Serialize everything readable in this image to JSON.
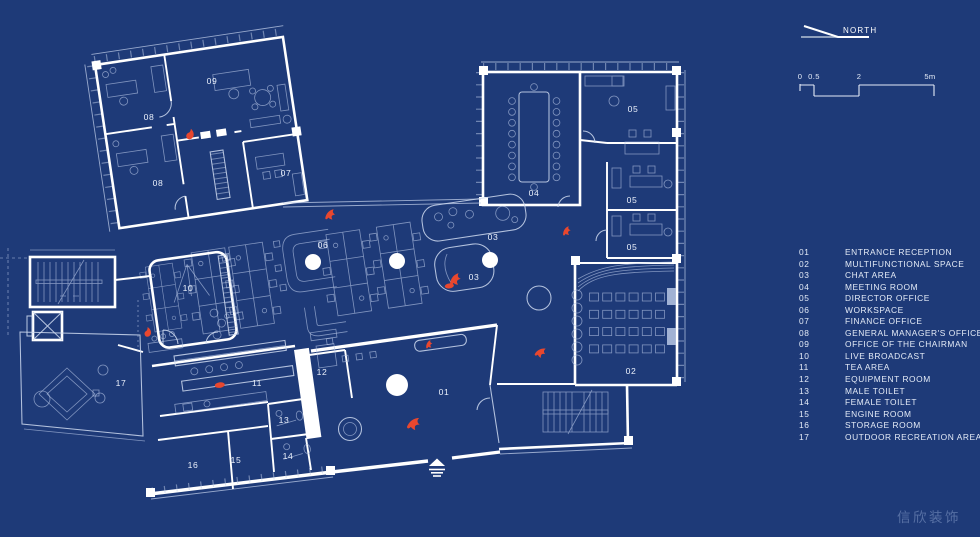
{
  "north": {
    "label": "NORTH"
  },
  "scale_bar": {
    "ticks": [
      {
        "label": "0",
        "x": 800
      },
      {
        "label": "0.5",
        "x": 814
      },
      {
        "label": "2",
        "x": 859
      },
      {
        "label": "5m",
        "x": 930
      }
    ]
  },
  "legend": {
    "items": [
      {
        "num": "01",
        "name": "ENTRANCE RECEPTION"
      },
      {
        "num": "02",
        "name": "MULTIFUNCTIONAL SPACE"
      },
      {
        "num": "03",
        "name": "CHAT AREA"
      },
      {
        "num": "04",
        "name": "MEETING ROOM"
      },
      {
        "num": "05",
        "name": "DIRECTOR OFFICE"
      },
      {
        "num": "06",
        "name": "WORKSPACE"
      },
      {
        "num": "07",
        "name": "FINANCE OFFICE"
      },
      {
        "num": "08",
        "name": "GENERAL MANAGER'S OFFICE"
      },
      {
        "num": "09",
        "name": "OFFICE OF THE CHAIRMAN"
      },
      {
        "num": "10",
        "name": "LIVE BROADCAST"
      },
      {
        "num": "11",
        "name": "TEA AREA"
      },
      {
        "num": "12",
        "name": "EQUIPMENT ROOM"
      },
      {
        "num": "13",
        "name": "MALE TOILET"
      },
      {
        "num": "14",
        "name": "FEMALE TOILET"
      },
      {
        "num": "15",
        "name": "ENGINE ROOM"
      },
      {
        "num": "16",
        "name": "STORAGE ROOM"
      },
      {
        "num": "17",
        "name": "OUTDOOR RECREATION AREA"
      }
    ]
  },
  "plan": {
    "room_labels": [
      {
        "num": "01",
        "x": 444,
        "y": 395
      },
      {
        "num": "02",
        "x": 631,
        "y": 374
      },
      {
        "num": "03",
        "x": 493,
        "y": 240
      },
      {
        "num": "03",
        "x": 474,
        "y": 280
      },
      {
        "num": "04",
        "x": 534,
        "y": 196
      },
      {
        "num": "05",
        "x": 633,
        "y": 112
      },
      {
        "num": "05",
        "x": 632,
        "y": 203
      },
      {
        "num": "05",
        "x": 632,
        "y": 250
      },
      {
        "num": "06",
        "x": 323,
        "y": 248
      },
      {
        "num": "07",
        "x": 286,
        "y": 176
      },
      {
        "num": "08",
        "x": 149,
        "y": 120
      },
      {
        "num": "08",
        "x": 158,
        "y": 186
      },
      {
        "num": "09",
        "x": 212,
        "y": 84
      },
      {
        "num": "10",
        "x": 188,
        "y": 291
      },
      {
        "num": "11",
        "x": 257,
        "y": 386
      },
      {
        "num": "12",
        "x": 322,
        "y": 375
      },
      {
        "num": "13",
        "x": 284,
        "y": 423
      },
      {
        "num": "14",
        "x": 288,
        "y": 459
      },
      {
        "num": "15",
        "x": 236,
        "y": 463
      },
      {
        "num": "16",
        "x": 193,
        "y": 468
      },
      {
        "num": "17",
        "x": 121,
        "y": 386
      }
    ],
    "columns": [
      {
        "x": 313,
        "y": 262,
        "r": 8
      },
      {
        "x": 397,
        "y": 261,
        "r": 8
      },
      {
        "x": 490,
        "y": 260,
        "r": 8
      },
      {
        "x": 397,
        "y": 385,
        "r": 11
      }
    ],
    "red_marks": [
      {
        "type": "flame",
        "x": 187,
        "y": 128,
        "rot": 10,
        "s": 1
      },
      {
        "type": "bird",
        "x": 324,
        "y": 211,
        "rot": -10,
        "s": 0.9
      },
      {
        "type": "bird",
        "x": 448,
        "y": 276,
        "rot": -15,
        "s": 1
      },
      {
        "type": "blob",
        "x": 445,
        "y": 284,
        "rot": -8,
        "s": 1
      },
      {
        "type": "bird",
        "x": 561,
        "y": 229,
        "rot": -20,
        "s": 0.75
      },
      {
        "type": "bird",
        "x": 536,
        "y": 347,
        "rot": 10,
        "s": 0.9
      },
      {
        "type": "flame",
        "x": 144,
        "y": 327,
        "rot": 0,
        "s": 0.9
      },
      {
        "type": "blob",
        "x": 215,
        "y": 383,
        "rot": -8,
        "s": 1.1
      },
      {
        "type": "bird",
        "x": 407,
        "y": 418,
        "rot": 0,
        "s": 1.1
      },
      {
        "type": "bird",
        "x": 424,
        "y": 343,
        "rot": -25,
        "s": 0.65
      }
    ]
  },
  "watermark": {
    "text": "信欣装饰"
  },
  "colors": {
    "background": "#1e3a78",
    "wall": "#ffffff",
    "detail_line": "#b7c6e6",
    "accent_red": "#e8472e",
    "label_text": "#eaf0fb"
  }
}
